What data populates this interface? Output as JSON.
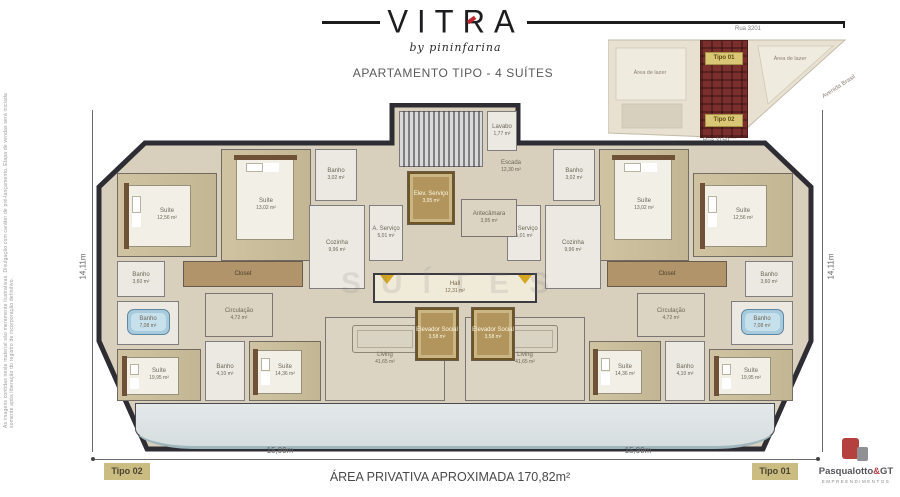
{
  "header": {
    "brand": "VITRA",
    "byline": "by pininfarina",
    "subtitle": "APARTAMENTO TIPO - 4 SUÍTES"
  },
  "sitemap": {
    "street_top": "Rua 3201",
    "street_bottom": "Rua 3150",
    "avenue": "Avenida Brasil",
    "leisure_left": "Área de lazer",
    "leisure_right": "Área de lazer",
    "unit_top": "Tipo 01",
    "unit_bottom": "Tipo 02",
    "building_color": "#7b2f2c",
    "label_color": "#d9c775"
  },
  "plan": {
    "width": 720,
    "height": 352,
    "watermark": "SUÍTES",
    "wall_color": "#2e2d33",
    "floor_color": "#d8d0bd",
    "gold_color": "#b2955d",
    "rooms": [
      {
        "name": "Suíte",
        "area": "12,56 m²",
        "type": "wood",
        "furn": "bed-h",
        "x": 22,
        "y": 70,
        "w": 100,
        "h": 84,
        "mirror": true
      },
      {
        "name": "Banho",
        "area": "3,60 m²",
        "type": "tile",
        "x": 22,
        "y": 158,
        "w": 48,
        "h": 36,
        "mirror": true
      },
      {
        "name": "Banho",
        "area": "7,08 m²",
        "type": "tile",
        "furn": "tub",
        "x": 22,
        "y": 198,
        "w": 62,
        "h": 44,
        "mirror": true
      },
      {
        "name": "Suíte",
        "area": "19,95 m²",
        "type": "wood",
        "furn": "bed-h",
        "x": 22,
        "y": 246,
        "w": 84,
        "h": 52,
        "mirror": true
      },
      {
        "name": "Suíte",
        "area": "13,02 m²",
        "type": "wood",
        "furn": "bed-v",
        "x": 126,
        "y": 46,
        "w": 90,
        "h": 112,
        "mirror": true
      },
      {
        "name": "Banho",
        "area": "3,02 m²",
        "type": "tile",
        "x": 220,
        "y": 46,
        "w": 42,
        "h": 52,
        "mirror": true
      },
      {
        "name": "Closet",
        "area": "",
        "type": "closet",
        "x": 88,
        "y": 158,
        "w": 120,
        "h": 26,
        "mirror": true
      },
      {
        "name": "Circulação",
        "area": "4,72 m²",
        "type": "light",
        "x": 110,
        "y": 190,
        "w": 68,
        "h": 44,
        "mirror": true
      },
      {
        "name": "Banho",
        "area": "4,10 m²",
        "type": "tile",
        "x": 110,
        "y": 238,
        "w": 40,
        "h": 60,
        "mirror": true
      },
      {
        "name": "Suíte",
        "area": "14,36 m²",
        "type": "wood",
        "furn": "bed-h",
        "x": 154,
        "y": 238,
        "w": 72,
        "h": 60,
        "mirror": true
      },
      {
        "name": "Cozinha",
        "area": "9,96 m²",
        "type": "tile",
        "x": 214,
        "y": 102,
        "w": 56,
        "h": 84,
        "mirror": true
      },
      {
        "name": "A. Serviço",
        "area": "5,01 m²",
        "type": "tile",
        "x": 274,
        "y": 102,
        "w": 34,
        "h": 56,
        "mirror": true
      },
      {
        "name": "Living",
        "area": "41,65 m²",
        "type": "light",
        "furn": "dining",
        "x": 230,
        "y": 214,
        "w": 120,
        "h": 84,
        "mirror": true
      },
      {
        "name": "Sacada",
        "area": "",
        "type": "label",
        "x": 70,
        "y": 312,
        "w": 60,
        "h": 16,
        "mirror": true
      },
      {
        "name": "Espaço Gourmet",
        "area": "",
        "type": "label",
        "x": 288,
        "y": 304,
        "w": 62,
        "h": 24,
        "mirror": true
      },
      {
        "type": "table-round",
        "x": 148,
        "y": 308,
        "w": 22,
        "h": 22,
        "mirror": true
      },
      {
        "type": "balcony",
        "x": 40,
        "y": 300,
        "w": 640,
        "h": 46
      },
      {
        "type": "stairs",
        "x": 304,
        "y": 8,
        "w": 84,
        "h": 56
      },
      {
        "name": "Escada",
        "area": "12,30 m²",
        "type": "label",
        "x": 386,
        "y": 52,
        "w": 60,
        "h": 24
      },
      {
        "name": "Lavabo",
        "area": "1,77 m²",
        "type": "tile",
        "x": 392,
        "y": 8,
        "w": 30,
        "h": 40
      },
      {
        "name": "Elev. Serviço",
        "area": "3,95 m²",
        "type": "gold",
        "x": 312,
        "y": 68,
        "w": 48,
        "h": 54
      },
      {
        "name": "Antecâmara",
        "area": "3,95 m²",
        "type": "light",
        "x": 366,
        "y": 96,
        "w": 56,
        "h": 38
      },
      {
        "name": "Hall",
        "area": "12,31 m²",
        "type": "hall",
        "x": 278,
        "y": 170,
        "w": 164,
        "h": 30
      },
      {
        "name": "Elevador Social",
        "area": "3,58 m²",
        "type": "gold",
        "x": 320,
        "y": 204,
        "w": 44,
        "h": 54
      },
      {
        "name": "Elevador Social",
        "area": "3,58 m²",
        "type": "gold",
        "x": 376,
        "y": 204,
        "w": 44,
        "h": 54
      },
      {
        "type": "arrow",
        "x": 284,
        "y": 172,
        "w": 16,
        "h": 10
      },
      {
        "type": "arrow",
        "x": 422,
        "y": 172,
        "w": 16,
        "h": 10
      }
    ]
  },
  "dimensions": {
    "side_left": "14,11m",
    "side_right": "14,11m",
    "bottom_left": "15,99m",
    "bottom_right": "15,99m"
  },
  "footer": {
    "unit_left": "Tipo 02",
    "unit_right": "Tipo 01",
    "area_text": "ÁREA PRIVATIVA APROXIMADA 170,82m²"
  },
  "developer": {
    "name_main": "Pasqualotto",
    "amp": "&",
    "suffix": "GT",
    "tagline": "EMPREENDIMENTOS"
  },
  "disclaimer": "As imagens contidas neste material são meramente ilustrativas. Divulgação com caráter de pré-lançamento. Etapa de vendas será iniciada somente após liberação do registro de incorporação definitivo."
}
